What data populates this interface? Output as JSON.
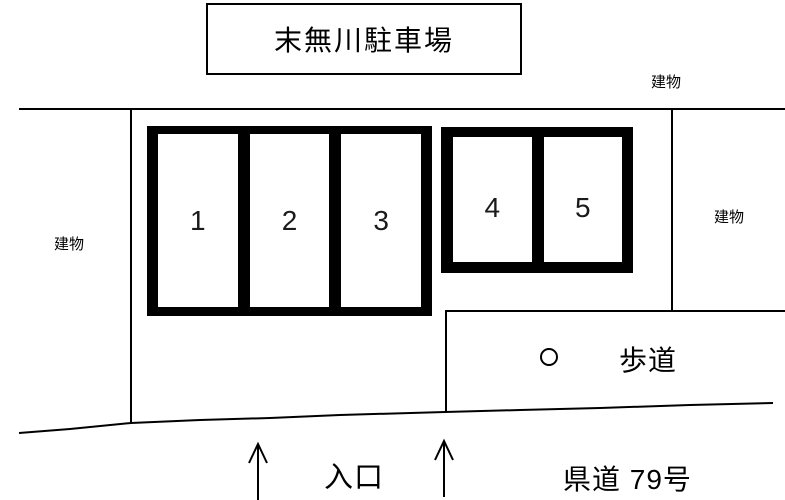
{
  "title": "末無川駐車場",
  "labels": {
    "building_top": "建物",
    "building_left": "建物",
    "building_right": "建物",
    "sidewalk": "歩道",
    "entrance": "入口",
    "road": "県道 79号"
  },
  "parking_spaces": {
    "block1": [
      "1",
      "2",
      "3"
    ],
    "block2": [
      "4",
      "5"
    ]
  },
  "icons": {
    "sidewalk_marker": "circle-icon",
    "entrance_arrows": "up-arrow-icon"
  },
  "colors": {
    "line": "#000000",
    "background": "#ffffff",
    "stall_fill": "#ffffff",
    "block_frame": "#000000"
  }
}
